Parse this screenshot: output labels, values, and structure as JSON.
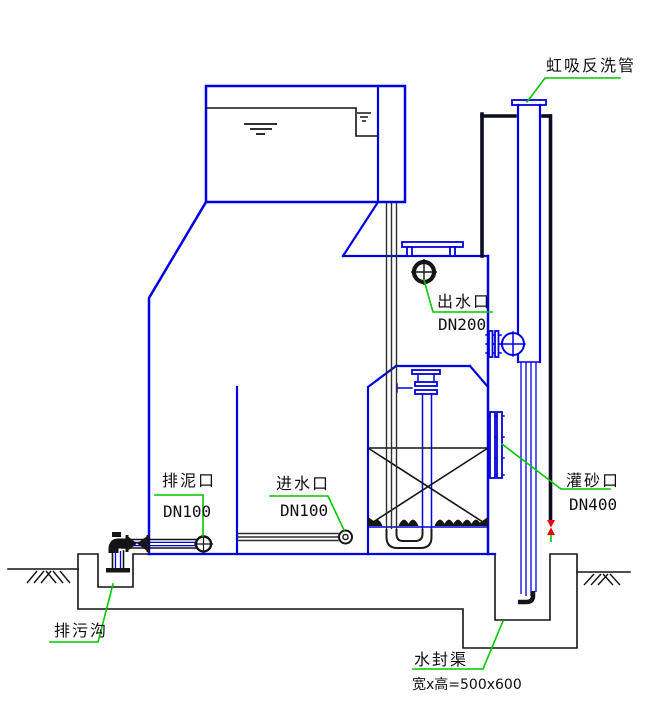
{
  "labels": {
    "siphon_backwash_pipe": {
      "text": "虹吸反洗管"
    },
    "water_outlet": {
      "text": "出水口",
      "spec": "DN200"
    },
    "mud_discharge_port": {
      "text": "排泥口",
      "spec": "DN100"
    },
    "water_inlet_port": {
      "text": "进水口",
      "spec": "DN100"
    },
    "sand_filling_port": {
      "text": "灌砂口",
      "spec": "DN400"
    },
    "sewage_ditch": {
      "text": "排污沟"
    },
    "water_seal_channel": {
      "text": "水封渠",
      "dimension": "宽x高=500x600"
    }
  },
  "colors": {
    "tank_outline_blue": "#0000e0",
    "line_black": "#141414",
    "column_dark": "#0c0c24",
    "leader_green": "#00c800",
    "valve_red": "#ee0000",
    "concrete_speckle": "#9a9a9a",
    "background": "#ffffff"
  }
}
